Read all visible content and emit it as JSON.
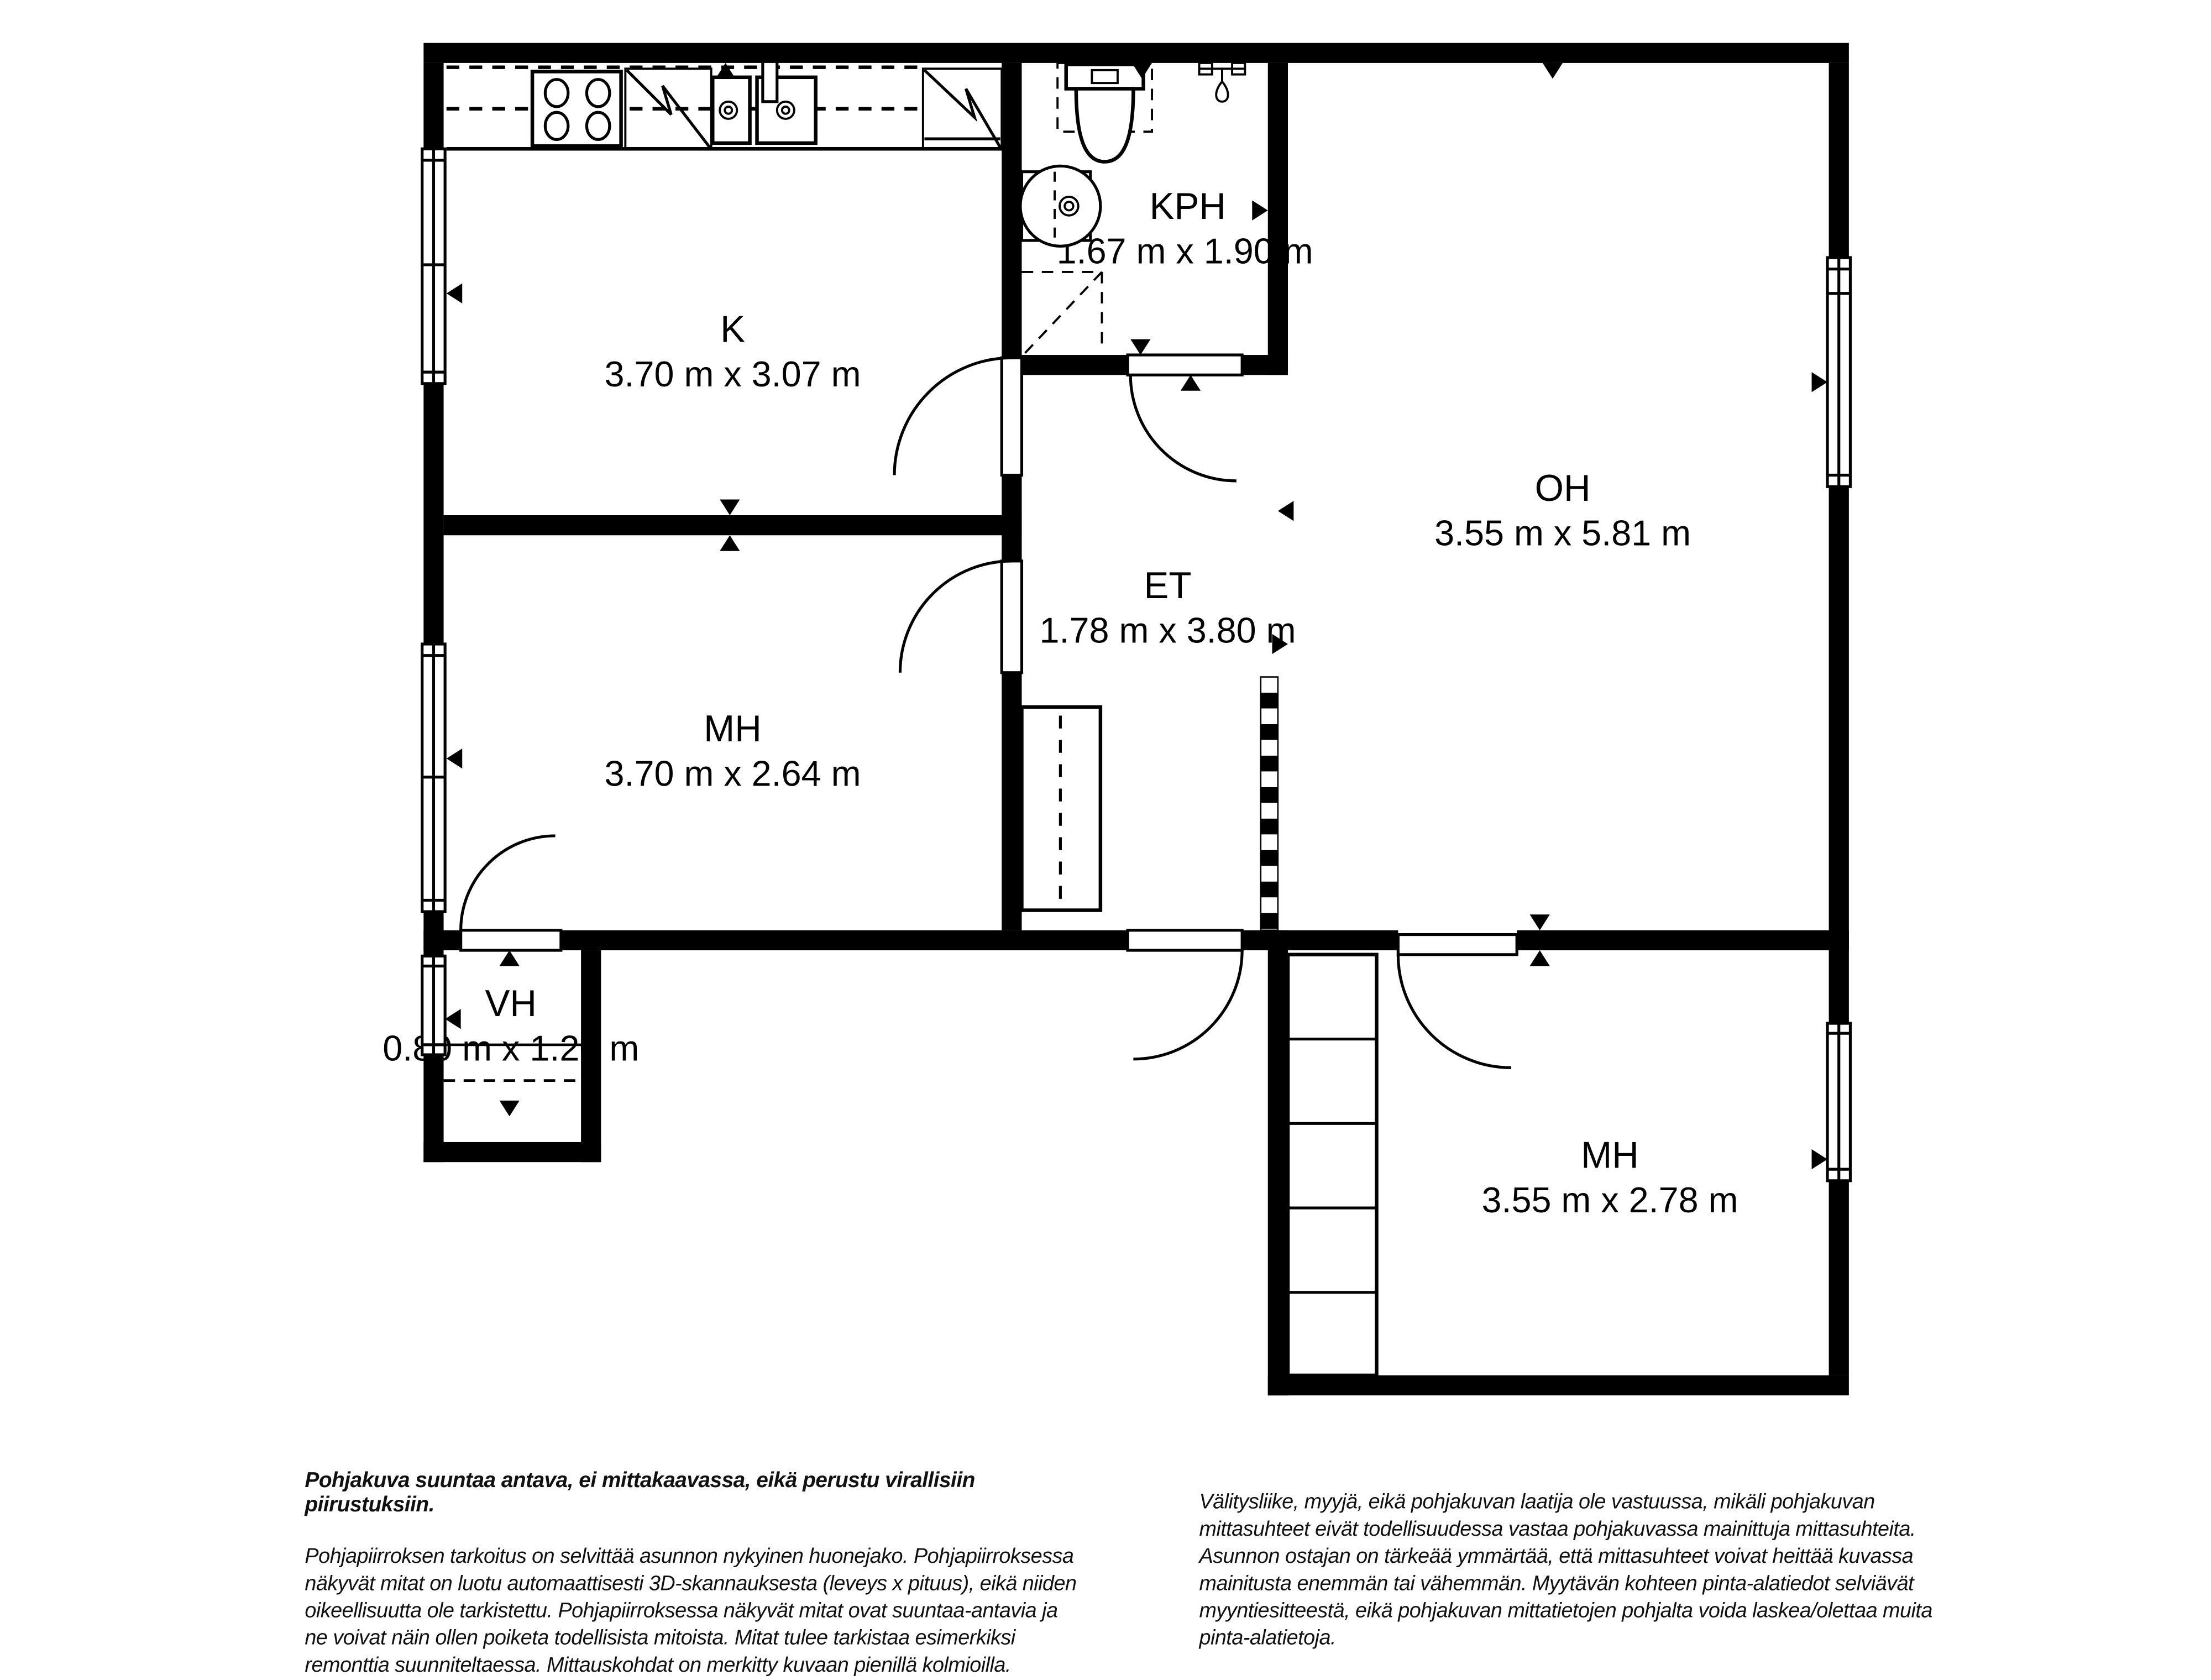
{
  "floorplan": {
    "type": "apartment-floor-plan",
    "colors": {
      "wall": "#000000",
      "background": "#ffffff",
      "line": "#000000"
    },
    "rooms": {
      "k": {
        "name": "K",
        "dims": "3.70 m x 3.07 m"
      },
      "kph": {
        "name": "KPH",
        "dims": "1.67 m x 1.90 m"
      },
      "oh": {
        "name": "OH",
        "dims": "3.55 m x 5.81 m"
      },
      "et": {
        "name": "ET",
        "dims": "1.78 m x 3.80 m"
      },
      "mh1": {
        "name": "MH",
        "dims": "3.70 m x 2.64 m"
      },
      "vh": {
        "name": "VH",
        "dims": "0.80 m x 1.20 m"
      },
      "mh2": {
        "name": "MH",
        "dims": "3.55 m x 2.78 m"
      }
    }
  },
  "disclaimer_left": {
    "title": "Pohjakuva suuntaa antava, ei mittakaavassa, eikä perustu virallisiin piirustuksiin.",
    "lines": [
      "Pohjapiirroksen tarkoitus on selvittää asunnon nykyinen huonejako. Pohjapiirroksessa",
      "näkyvät mitat on luotu automaattisesti 3D-skannauksesta (leveys x pituus), eikä niiden",
      "oikeellisuutta ole tarkistettu. Pohjapiirroksessa näkyvät mitat ovat suuntaa-antavia ja",
      "ne voivat näin ollen poiketa todellisista mitoista. Mitat tulee tarkistaa esimerkiksi",
      "remonttia suunniteltaessa. Mittauskohdat on merkitty kuvaan pienillä kolmioilla."
    ]
  },
  "disclaimer_right": {
    "lines": [
      "Välitysliike, myyjä, eikä pohjakuvan laatija ole vastuussa, mikäli pohjakuvan",
      "mittasuhteet eivät todellisuudessa vastaa pohjakuvassa mainittuja mittasuhteita.",
      "Asunnon ostajan on tärkeää ymmärtää, että mittasuhteet voivat heittää kuvassa",
      "mainitusta enemmän tai vähemmän. Myytävän kohteen pinta-alatiedot selviävät",
      "myyntiesitteestä, eikä pohjakuvan mittatietojen pohjalta voida laskea/olettaa muita",
      "pinta-alatietoja."
    ]
  }
}
